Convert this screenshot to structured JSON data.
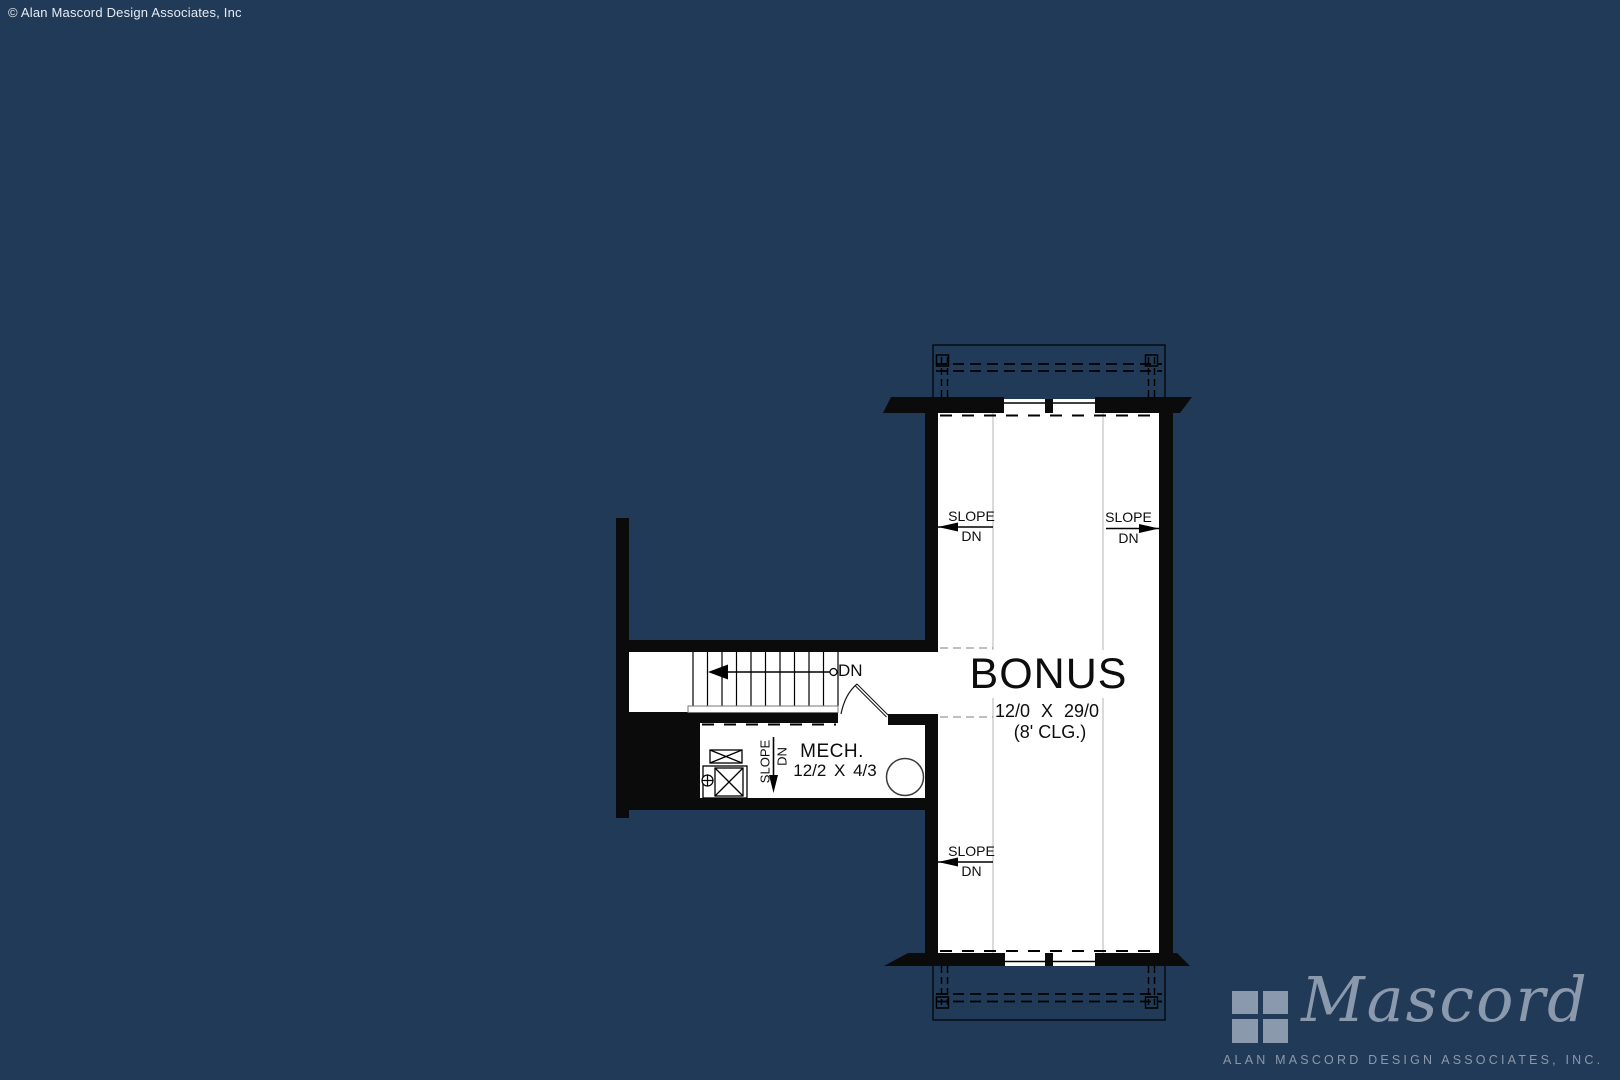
{
  "page": {
    "background": "#213a58"
  },
  "copyright": "© Alan Mascord Design Associates, Inc",
  "plan": {
    "bonus_room": {
      "name": "BONUS",
      "dimensions": "12/0 X 29/0",
      "ceiling_height": "(8' CLG.)"
    },
    "mech_room": {
      "name": "MECH.",
      "dimensions": "12/2 X 4/3"
    },
    "slope_label": "SLOPE",
    "down_label": "DN",
    "stair_down_label": "DN"
  },
  "logo": {
    "name": "Mascord",
    "subtitle": "ALAN MASCORD DESIGN ASSOCIATES, INC.",
    "color": "#8b99ac"
  },
  "colors": {
    "background": "#213a58",
    "walls": "#0b0b0b",
    "room_fill": "#ffffff",
    "slope_break_line": "#b5b5b5",
    "dashed_ceiling_line": "#999999",
    "logo": "#8b99ac"
  }
}
